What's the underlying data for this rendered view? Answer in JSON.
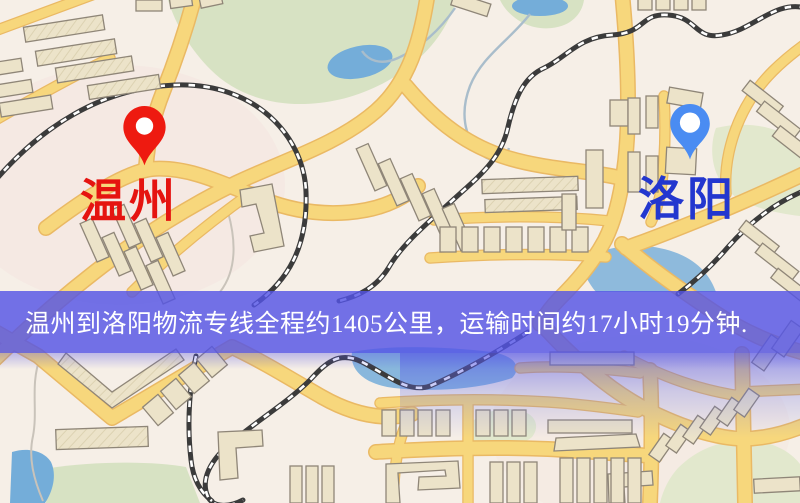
{
  "colors": {
    "bg": "#f6efe7",
    "road-fill": "#f7d77c",
    "road-edge": "#eab964",
    "rail": "#3b3b3b",
    "building-fill": "#ece3c9",
    "building-edge": "#8f8678",
    "park": "#d7e2c3",
    "park-pale": "#e2e8cd",
    "water": "#74add9",
    "banner-bg": "rgba(84,84,229,0.82)",
    "banner-text": "#ffffff",
    "origin-pin": "#ee1a10",
    "origin-label": "#e51410",
    "dest-pin": "#4a8cf2",
    "dest-label": "#2337cf"
  },
  "banner": {
    "text": "温州到洛阳物流专线全程约1405公里，运输时间约17小时19分钟."
  },
  "route": {
    "origin": "温州",
    "destination": "洛阳",
    "distance_text": "约1405公里",
    "duration_text": "约17小时19分钟"
  },
  "markers": {
    "origin": {
      "label": "温州"
    },
    "destination": {
      "label": "洛阳"
    }
  }
}
